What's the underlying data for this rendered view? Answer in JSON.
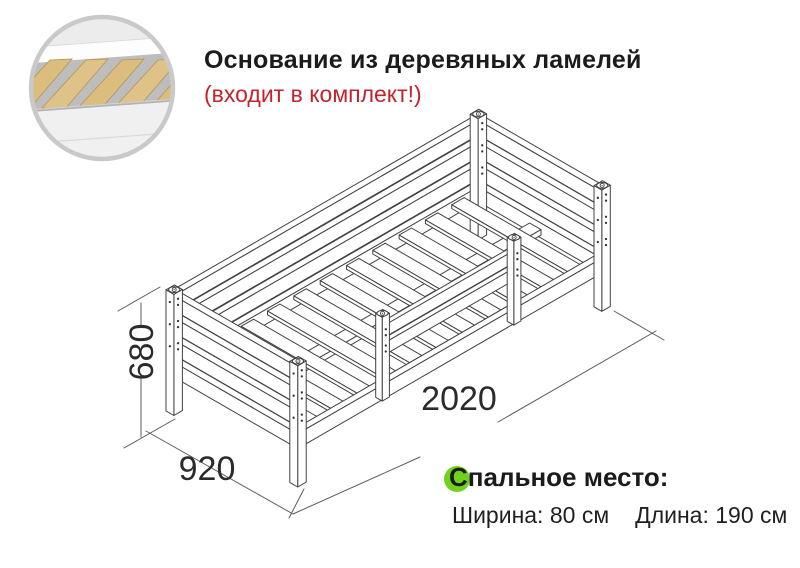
{
  "header": {
    "title": "Основание из деревяных ламелей",
    "note": "(входит в комплект!)"
  },
  "dimensions": {
    "height_label": "680",
    "depth_label": "920",
    "length_label": "2020"
  },
  "sleeping_area": {
    "heading": "Спальное место:",
    "width_spec": "Ширина: 80 см",
    "length_spec": "Длина: 190 см"
  },
  "colors": {
    "text": "#1b1b1b",
    "accent_red": "#c4222d",
    "accent_green": "#70d11f",
    "line_art": "#414141",
    "dim_line": "#5c5c5c",
    "wood": "#dcbd80",
    "inset_ring": "#c9c9c9"
  },
  "bed_model_mm": {
    "length": 2020,
    "width": 920,
    "height": 680
  }
}
